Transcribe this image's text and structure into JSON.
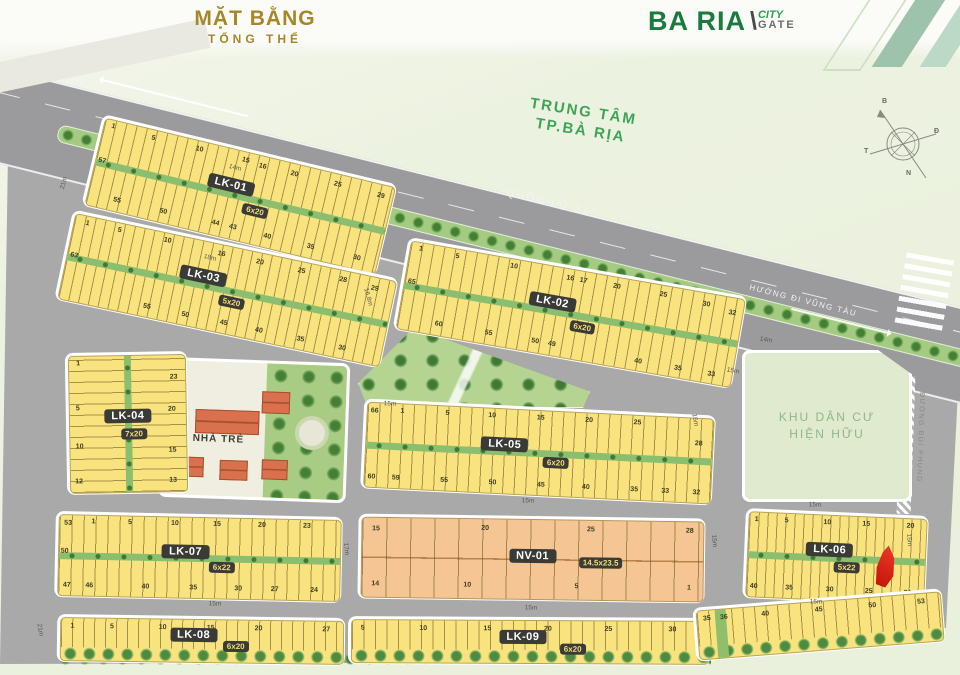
{
  "header": {
    "title_line1": "MẶT BẰNG",
    "title_line2": "TỔNG THỂ",
    "logo": {
      "part1": "BA RIA",
      "slash": "\\",
      "city": "CITY",
      "gate": "GATE"
    }
  },
  "map": {
    "highway_label": "QUỐC LỘ 51",
    "dir_hcm": "HƯỚNG ĐI TP.HỒ CHÍ MINH",
    "dir_vt": "HƯỚNG ĐI VŨNG TÀU",
    "center_label_1": "TRUNG TÂM",
    "center_label_2": "TP.BÀ RỊA",
    "khu_dan_cu_1": "KHU DÂN CƯ",
    "khu_dan_cu_2": "HIỆN HỮU",
    "nha_tre": "NHÀ TRẺ",
    "duong_bui_phung": "ĐƯỜNG BÙI PHỤNG",
    "compass": {
      "n": "B",
      "e": "Đ",
      "s": "N",
      "w": "T"
    }
  },
  "colors": {
    "lot_yellow": "#f9e37f",
    "lot_orange": "#f5c693",
    "road_gray": "#a9a9a9",
    "accent_green": "#1b7a3d",
    "title_gold": "#a6872a",
    "marker_red": "#e2261a"
  },
  "blocks": [
    {
      "id": "lk-01",
      "label": "LK-01",
      "dim": "6x20",
      "x": 88,
      "y": 148,
      "w": 303,
      "h": 94,
      "rot": 13.5,
      "type": "2row",
      "lw": 10.5,
      "lx": 46,
      "ly": 40,
      "dx": 56,
      "dy": 63,
      "nums": [
        [
          "1",
          3,
          7
        ],
        [
          "5",
          17,
          9
        ],
        [
          "10",
          33,
          9
        ],
        [
          "15",
          49,
          9
        ],
        [
          "16",
          55,
          11
        ],
        [
          "20",
          66,
          11
        ],
        [
          "25",
          81,
          11
        ],
        [
          "29",
          96,
          13
        ],
        [
          "57",
          2,
          48
        ],
        [
          "55",
          10,
          87
        ],
        [
          "50",
          26,
          87
        ],
        [
          "44",
          44,
          86
        ],
        [
          "43",
          50,
          86
        ],
        [
          "40",
          62,
          88
        ],
        [
          "35",
          77,
          88
        ],
        [
          "30",
          93,
          88
        ]
      ]
    },
    {
      "id": "lk-03",
      "label": "LK-03",
      "dim": "5x20",
      "x": 60,
      "y": 243,
      "w": 333,
      "h": 92,
      "rot": 12,
      "type": "2row",
      "lw": 10,
      "lx": 42,
      "ly": 40,
      "dx": 52,
      "dy": 63,
      "nums": [
        [
          "1",
          4,
          8
        ],
        [
          "5",
          14,
          8
        ],
        [
          "10",
          29,
          8
        ],
        [
          "16",
          46,
          10
        ],
        [
          "20",
          58,
          10
        ],
        [
          "25",
          71,
          10
        ],
        [
          "28",
          84,
          10
        ],
        [
          "29",
          94,
          13
        ],
        [
          "63",
          2,
          48
        ],
        [
          "55",
          27,
          88
        ],
        [
          "50",
          39,
          88
        ],
        [
          "45",
          51,
          88
        ],
        [
          "40",
          62,
          88
        ],
        [
          "35",
          75,
          88
        ],
        [
          "30",
          88,
          88
        ]
      ]
    },
    {
      "id": "lk-02",
      "label": "LK-02",
      "dim": "6x20",
      "x": 398,
      "y": 266,
      "w": 344,
      "h": 94,
      "rot": 10,
      "type": "2row",
      "lw": 11,
      "lx": 44,
      "ly": 40,
      "dx": 54,
      "dy": 63,
      "nums": [
        [
          "1",
          3,
          7
        ],
        [
          "5",
          14,
          8
        ],
        [
          "10",
          31,
          8
        ],
        [
          "16",
          48,
          10
        ],
        [
          "17",
          52,
          10
        ],
        [
          "20",
          62,
          10
        ],
        [
          "25",
          76,
          10
        ],
        [
          "30",
          89,
          13
        ],
        [
          "32",
          97,
          17
        ],
        [
          "65",
          2,
          45
        ],
        [
          "60",
          12,
          88
        ],
        [
          "55",
          27,
          88
        ],
        [
          "50",
          41,
          88
        ],
        [
          "49",
          46,
          88
        ],
        [
          "40",
          72,
          90
        ],
        [
          "35",
          84,
          90
        ],
        [
          "33",
          94,
          90
        ]
      ]
    },
    {
      "id": "lk-04",
      "label": "LK-04",
      "dim": "7x20",
      "x": 66,
      "y": 352,
      "w": 122,
      "h": 142,
      "rot": -1,
      "type": "2col",
      "lh": 11,
      "lx": 50,
      "ly": 44,
      "dx": 55,
      "dy": 57,
      "nums": [
        [
          "1",
          8,
          5
        ],
        [
          "23",
          90,
          16
        ],
        [
          "5",
          7,
          38
        ],
        [
          "20",
          88,
          40
        ],
        [
          "10",
          8,
          66
        ],
        [
          "15",
          88,
          70
        ],
        [
          "12",
          7,
          92
        ],
        [
          "13",
          88,
          92
        ]
      ]
    },
    {
      "id": "lk-05",
      "label": "LK-05",
      "dim": "6x20",
      "x": 362,
      "y": 407,
      "w": 352,
      "h": 90,
      "rot": 2.8,
      "type": "2row",
      "lw": 11.5,
      "lx": 40,
      "ly": 42,
      "dx": 55,
      "dy": 61,
      "nums": [
        [
          "66",
          2,
          10
        ],
        [
          "1",
          10,
          8
        ],
        [
          "5",
          23,
          8
        ],
        [
          "10",
          36,
          8
        ],
        [
          "15",
          50,
          8
        ],
        [
          "20",
          64,
          8
        ],
        [
          "25",
          78,
          8
        ],
        [
          "28",
          96,
          30
        ],
        [
          "60",
          2,
          88
        ],
        [
          "59",
          9,
          88
        ],
        [
          "55",
          23,
          88
        ],
        [
          "50",
          37,
          88
        ],
        [
          "45",
          51,
          88
        ],
        [
          "40",
          64,
          88
        ],
        [
          "35",
          78,
          88
        ],
        [
          "33",
          87,
          88
        ],
        [
          "32",
          96,
          88
        ]
      ]
    },
    {
      "id": "lk-07",
      "label": "LK-07",
      "dim": "6x22",
      "x": 55,
      "y": 514,
      "w": 287,
      "h": 86,
      "rot": 1.2,
      "type": "2row",
      "lw": 12,
      "lx": 45,
      "ly": 42,
      "dx": 58,
      "dy": 61,
      "nums": [
        [
          "53",
          3,
          10
        ],
        [
          "1",
          12,
          8
        ],
        [
          "5",
          25,
          8
        ],
        [
          "10",
          41,
          8
        ],
        [
          "15",
          56,
          8
        ],
        [
          "20",
          72,
          8
        ],
        [
          "23",
          88,
          8
        ],
        [
          "50",
          2,
          45
        ],
        [
          "47",
          3,
          88
        ],
        [
          "46",
          11,
          88
        ],
        [
          "40",
          31,
          88
        ],
        [
          "35",
          48,
          88
        ],
        [
          "30",
          64,
          88
        ],
        [
          "27",
          77,
          88
        ],
        [
          "24",
          91,
          88
        ]
      ]
    },
    {
      "id": "nv-01",
      "label": "NV-01",
      "dim": "14.5x23.5",
      "x": 358,
      "y": 516,
      "w": 347,
      "h": 85,
      "rot": 0.8,
      "type": "nv",
      "lw": 24,
      "lx": 50,
      "ly": 46,
      "dx": 70,
      "dy": 53,
      "nums": [
        [
          "15",
          4,
          14
        ],
        [
          "20",
          36,
          12
        ],
        [
          "25",
          67,
          12
        ],
        [
          "28",
          96,
          12
        ],
        [
          "14",
          4,
          84
        ],
        [
          "10",
          31,
          84
        ],
        [
          "5",
          63,
          84
        ],
        [
          "1",
          96,
          84
        ]
      ]
    },
    {
      "id": "lk-06",
      "label": "LK-06",
      "dim": "5x22",
      "x": 744,
      "y": 512,
      "w": 183,
      "h": 90,
      "rot": 2.5,
      "type": "2row",
      "lw": 9,
      "lx": 46,
      "ly": 40,
      "dx": 56,
      "dy": 61,
      "nums": [
        [
          "1",
          4,
          8
        ],
        [
          "5",
          21,
          8
        ],
        [
          "10",
          44,
          8
        ],
        [
          "15",
          66,
          8
        ],
        [
          "20",
          91,
          8
        ],
        [
          "40",
          4,
          88
        ],
        [
          "35",
          24,
          88
        ],
        [
          "30",
          47,
          88
        ],
        [
          "25",
          69,
          88
        ],
        [
          "21",
          91,
          88
        ]
      ]
    },
    {
      "id": "lk-08",
      "label": "LK-08",
      "dim": "6x20",
      "x": 57,
      "y": 616,
      "w": 288,
      "h": 48,
      "rot": 0.8,
      "type": "1row",
      "lw": 11,
      "trees": true,
      "lx": 47,
      "ly": 36,
      "dx": 62,
      "dy": 62,
      "nums": [
        [
          "1",
          4,
          20
        ],
        [
          "5",
          18,
          18
        ],
        [
          "10",
          36,
          18
        ],
        [
          "15",
          53,
          18
        ],
        [
          "20",
          70,
          18
        ],
        [
          "27",
          94,
          18
        ]
      ]
    },
    {
      "id": "lk-09",
      "label": "LK-09",
      "dim": "6x20",
      "x": 348,
      "y": 617,
      "w": 362,
      "h": 48,
      "rot": 0.3,
      "type": "1row",
      "lw": 11.5,
      "trees": true,
      "lx": 48,
      "ly": 38,
      "dx": 62,
      "dy": 66,
      "nums": [
        [
          "5",
          3,
          18
        ],
        [
          "10",
          20,
          18
        ],
        [
          "15",
          38,
          18
        ],
        [
          "20",
          55,
          18
        ],
        [
          "25",
          72,
          18
        ],
        [
          "30",
          90,
          18
        ]
      ]
    },
    {
      "id": "lk-09b",
      "label": "",
      "dim": "",
      "x": 694,
      "y": 598,
      "w": 250,
      "h": 54,
      "rot": -4.5,
      "type": "1row",
      "lw": 11.5,
      "trees": true,
      "greenLot": {
        "x": 7.5,
        "w": 4.5
      },
      "nums": [
        [
          "35",
          4,
          16
        ],
        [
          "36",
          11,
          16
        ],
        [
          "40",
          28,
          16
        ],
        [
          "45",
          50,
          16
        ],
        [
          "50",
          72,
          16
        ],
        [
          "53",
          92,
          16
        ]
      ]
    }
  ],
  "dimensions": [
    [
      "21m",
      64,
      183,
      -75
    ],
    [
      "14m",
      235,
      168,
      14
    ],
    [
      "18m",
      210,
      258,
      14
    ],
    [
      "16.8m",
      368,
      297,
      75
    ],
    [
      "15m",
      390,
      404,
      3
    ],
    [
      "14m",
      766,
      340,
      10
    ],
    [
      "15m",
      733,
      371,
      10
    ],
    [
      "16m",
      695,
      420,
      80
    ],
    [
      "15m",
      528,
      501,
      2
    ],
    [
      "17m",
      346,
      549,
      85
    ],
    [
      "15m",
      714,
      541,
      85
    ],
    [
      "15m",
      909,
      540,
      85
    ],
    [
      "15m",
      815,
      505,
      2
    ],
    [
      "15m",
      816,
      602,
      2
    ],
    [
      "15m",
      215,
      604,
      2
    ],
    [
      "21m",
      40,
      630,
      80
    ],
    [
      "15m",
      531,
      608,
      2
    ]
  ]
}
